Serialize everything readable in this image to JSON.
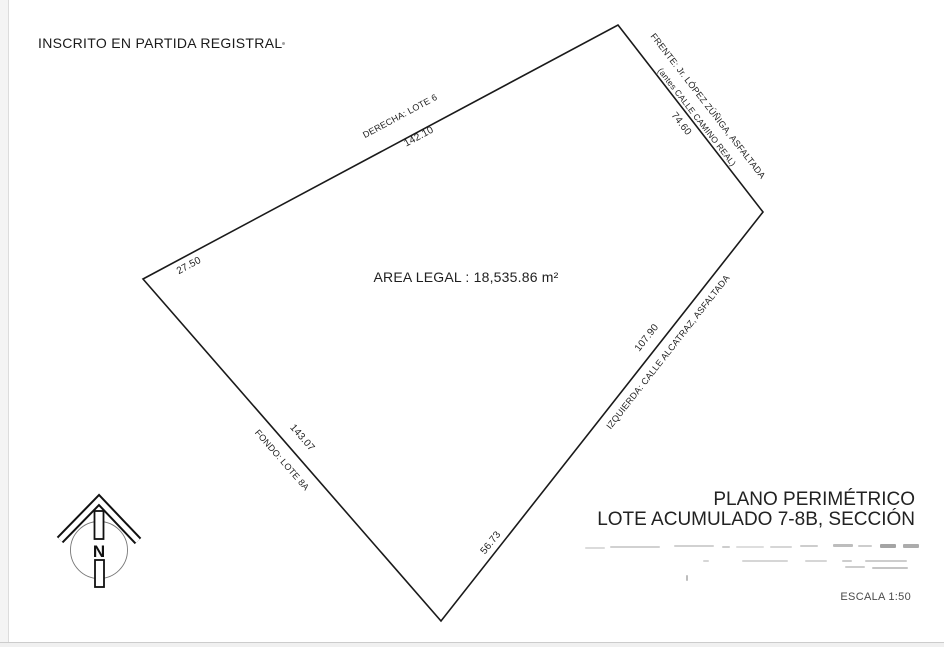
{
  "document": {
    "registry_note": "INSCRITO EN PARTIDA REGISTRAL",
    "area_label": "AREA LEGAL : 18,535.86 m²"
  },
  "parcel": {
    "edges": [
      {
        "position": "top",
        "name": "DERECHA: LOTE 6",
        "length": "142.10",
        "partial_length": "27.50"
      },
      {
        "position": "upper_right",
        "name": "FRENTE: Jr. LÓPEZ ZÚÑIGA, ASFALTADA",
        "former_name": "(antes CALLE CAMINO REAL)",
        "length": "74.60"
      },
      {
        "position": "lower_right",
        "name": "IZQUIERDA: CALLE ALCATRAZ, ASFALTADA",
        "length": "107.90",
        "partial_length": "56.73"
      },
      {
        "position": "lower_left",
        "name": "FONDO: LOTE 8A",
        "length": "143.07"
      }
    ],
    "line_color": "#1a1a1a"
  },
  "north_indicator": {
    "label": "N"
  },
  "title_block": {
    "line1": "PLANO PERIMÉTRICO",
    "line2": "LOTE ACUMULADO 7-8B, SECCIÓN",
    "scale": "ESCALA 1:50"
  }
}
